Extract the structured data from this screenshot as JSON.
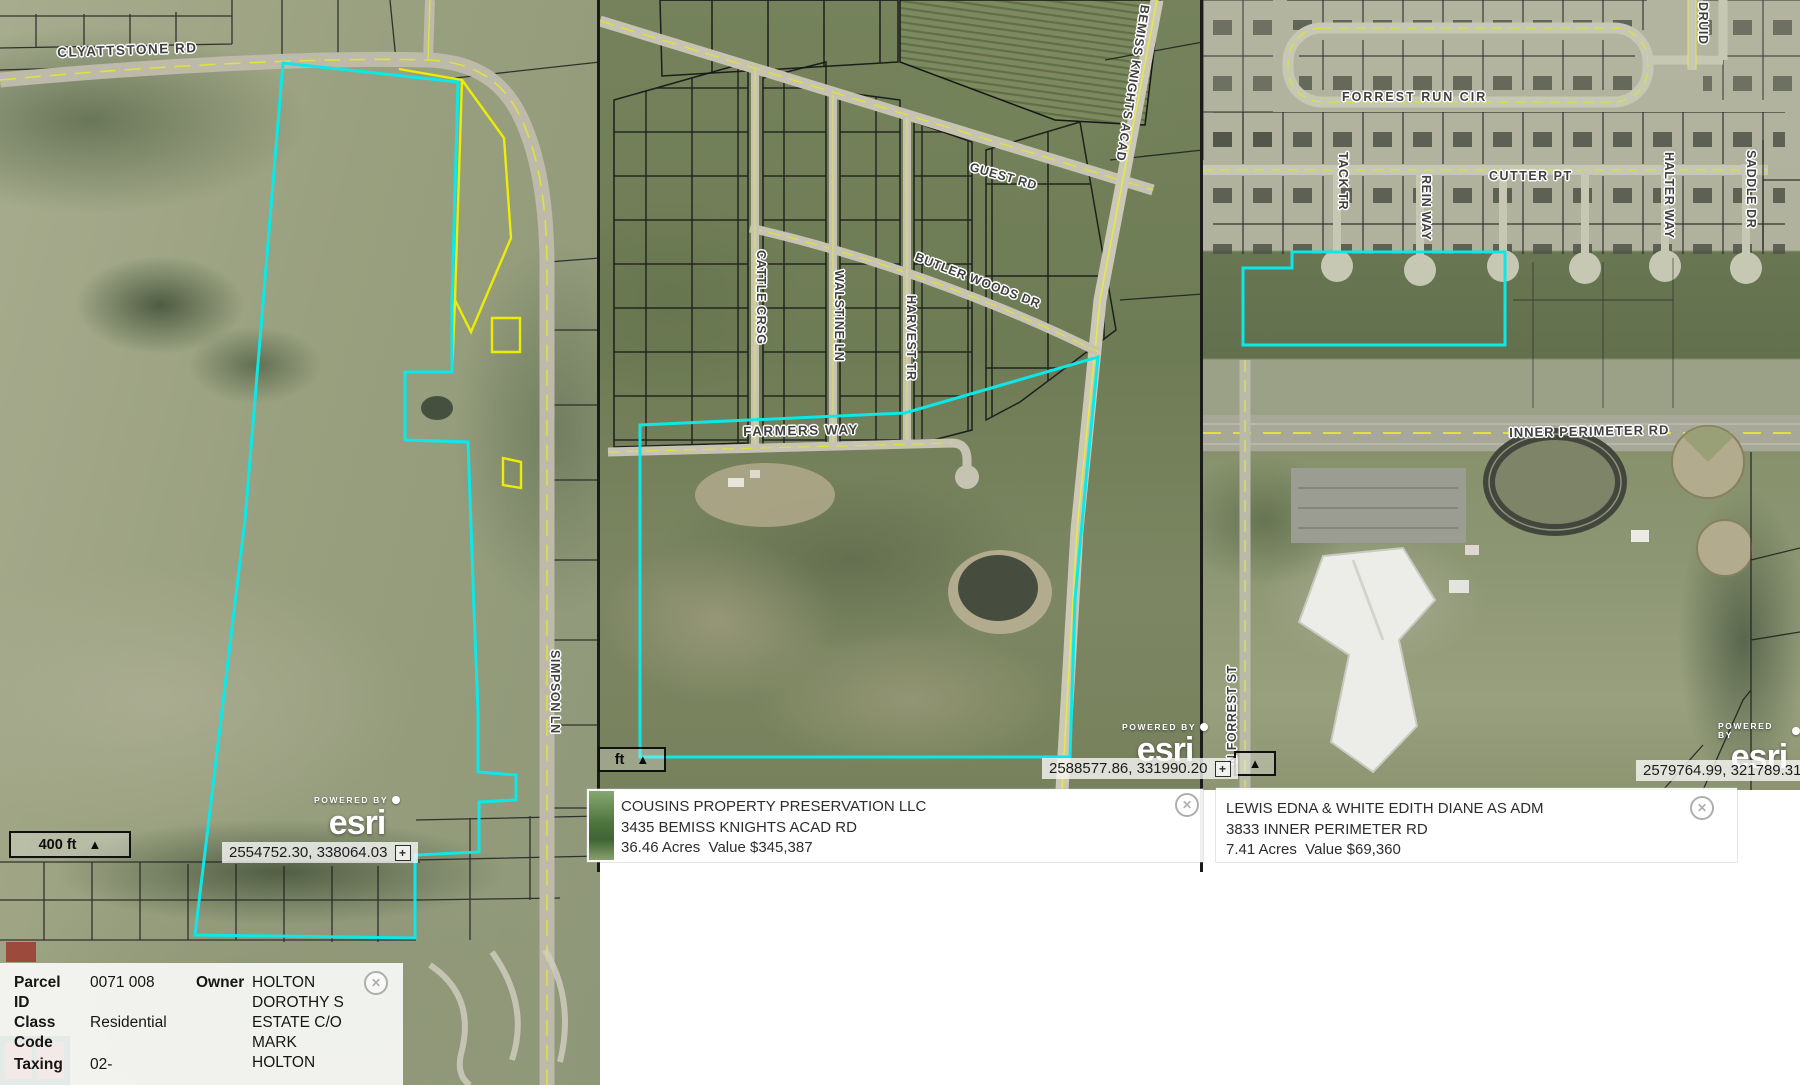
{
  "icons": {
    "close": "✕",
    "plus": "+",
    "triangle": "▲"
  },
  "colors": {
    "parcel_highlight": "#0ce8e8",
    "secondary_outline": "#ecec07",
    "road_centerline": "#dde23c"
  },
  "left": {
    "labels": {
      "clyattstone": "CLYATTSTONE RD",
      "simpson": "SIMPSON LN"
    },
    "scale_text": "400 ft",
    "powered_by": "POWERED BY",
    "esri": "esri",
    "coordinates": "2554752.30, 338064.03",
    "popup": {
      "fields": [
        {
          "label": "Parcel ID",
          "value": "0071 008"
        },
        {
          "label": "Class Code",
          "value": "Residential"
        },
        {
          "label": "Taxing",
          "value": "02-"
        }
      ],
      "owner_label": "Owner",
      "owner_value": "HOLTON DOROTHY S ESTATE C/O MARK HOLTON"
    }
  },
  "middle": {
    "labels": {
      "guest": "GUEST RD",
      "bemiss": "BEMISS KNIGHTS ACAD",
      "butler": "BUTLER WOODS DR",
      "cattle": "CATTLE CRSG",
      "walstine": "WALSTINE LN",
      "harvest": "HARVEST TR",
      "farmers": "FARMERS WAY"
    },
    "scale_text": "ft",
    "powered_by": "POWERED BY",
    "esri": "esri",
    "coordinates": "2588577.86, 331990.20",
    "info": {
      "name": "COUSINS PROPERTY PRESERVATION LLC",
      "address": "3435 BEMISS KNIGHTS ACAD RD",
      "details": "36.46 Acres  Value $345,387"
    }
  },
  "right": {
    "labels": {
      "forrest_run": "FORREST RUN CIR",
      "cutter": "CUTTER PT",
      "tack": "TACK TR",
      "rein": "REIN WAY",
      "halter": "HALTER WAY",
      "saddle": "SADDLE DR",
      "druid": "DRUID",
      "inner_perimeter": "INNER PERIMETER RD",
      "n_forrest": "N FORREST ST"
    },
    "powered_by": "POWERED BY",
    "esri": "esri",
    "coordinates": "2579764.99, 321789.31",
    "info": {
      "name": "LEWIS EDNA & WHITE EDITH DIANE AS ADM",
      "address": "3833 INNER PERIMETER RD",
      "details": "7.41 Acres  Value $69,360"
    }
  }
}
